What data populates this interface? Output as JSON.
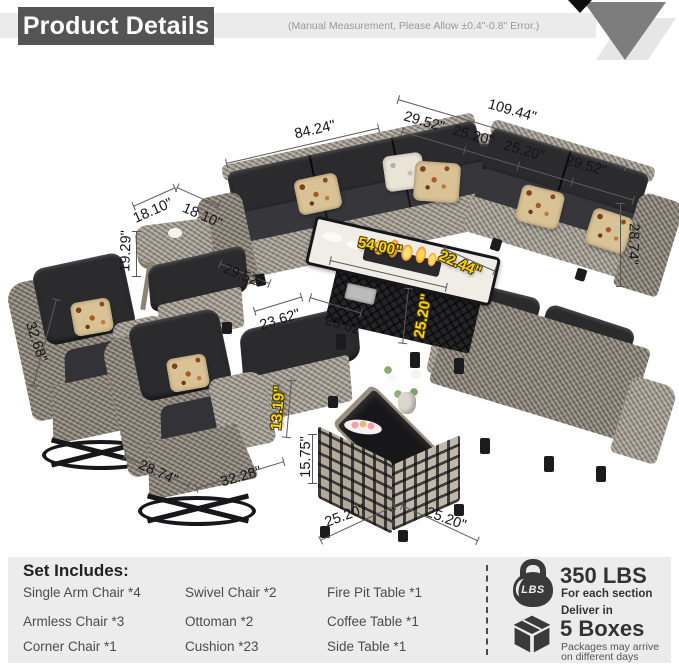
{
  "header": {
    "title": "Product Details",
    "note": "(Manual Measurement, Please Allow ±0.4\"-0.8\" Error.)"
  },
  "dims": {
    "sofa_overall_width": "109.44\"",
    "sofa_left_width": "84.24\"",
    "sofa_seg1": "29.52\"",
    "sofa_seg2": "25.20\"",
    "sofa_seg3": "25.20\"",
    "sofa_seg4": "29.52\"",
    "sofa_height": "28.74\"",
    "sofa_depth": "29.52\"",
    "side_table_width": "18.10\"",
    "side_table_depth": "18.10\"",
    "side_table_height": "19.29\"",
    "chair_height": "32.68\"",
    "chair_depth": "28.74\"",
    "chair_width": "32.28\"",
    "ottoman_width": "23.62\"",
    "ottoman_depth": "23.62\"",
    "ottoman_height": "13.19\"",
    "firepit_length": "54.00\"",
    "firepit_depth": "22.44\"",
    "firepit_height": "25.20\"",
    "coffee_height": "15.75\"",
    "coffee_width": "25.20\"",
    "coffee_depth": "25.20\"",
    "unit_note": "inches"
  },
  "set_includes": {
    "title": "Set Includes:",
    "col1": [
      "Single Arm Chair *4",
      "Armless Chair  *3",
      "Corner Chair *1"
    ],
    "col2": [
      "Swivel Chair *2",
      "Ottoman *2",
      "Cushion *23"
    ],
    "col3": [
      "Fire Pit Table *1",
      "Coffee Table *1",
      "Side Table *1"
    ]
  },
  "load_info": {
    "icon_label": "LBS",
    "value": "350 LBS",
    "caption": "For each section"
  },
  "delivery_info": {
    "pre": "Deliver in",
    "value": "5 Boxes",
    "caption_line1": "Packages may arrive",
    "caption_line2": "on different days"
  },
  "colors": {
    "accent_yellow": "#ffd400",
    "banner_gray": "#545454",
    "panel_gray": "#ececec",
    "cushion_black": "#2b2b2e",
    "wicker_gray": "#9e978b"
  }
}
